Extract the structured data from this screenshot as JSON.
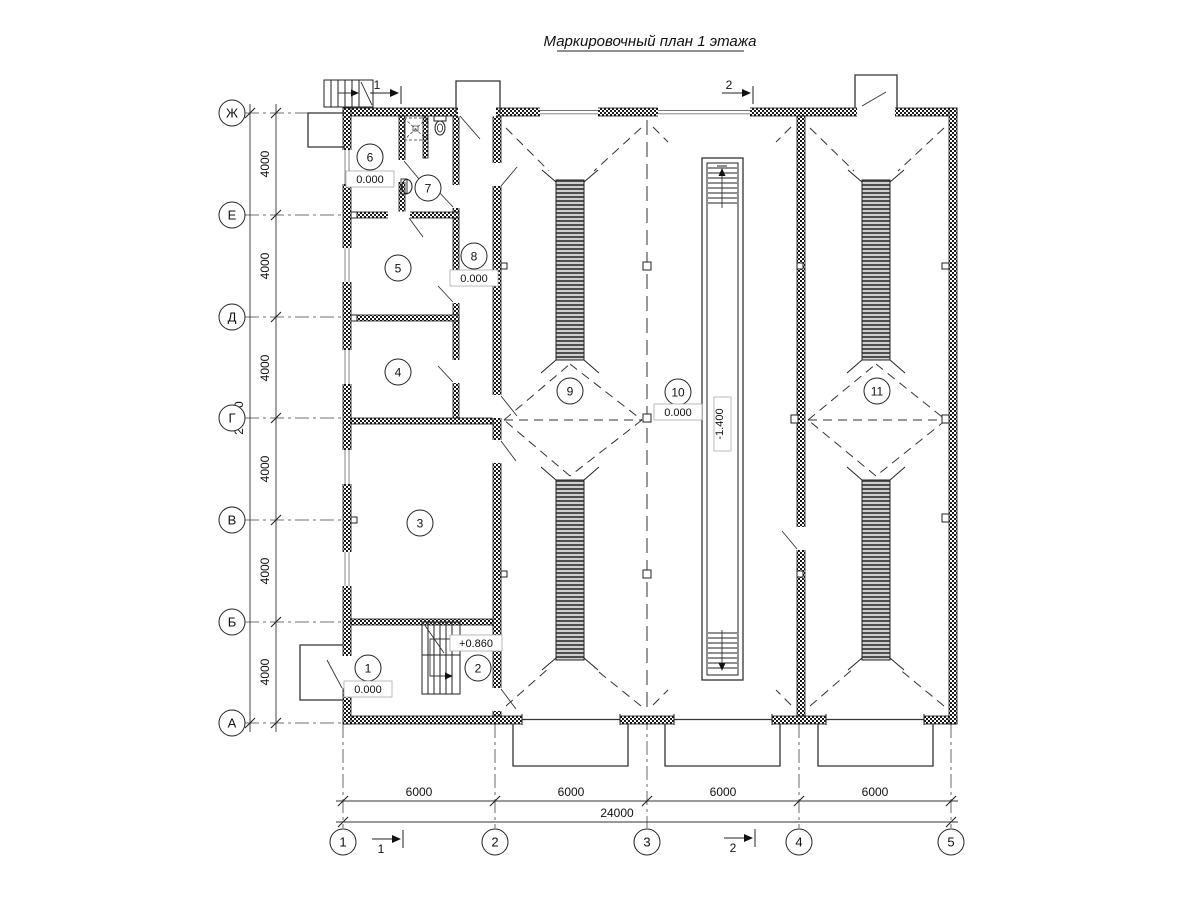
{
  "title": "Маркировочный план 1 этажа",
  "axes": {
    "rows": [
      "Ж",
      "Е",
      "Д",
      "Г",
      "В",
      "Б",
      "А"
    ],
    "cols": [
      "1",
      "2",
      "3",
      "4",
      "5"
    ]
  },
  "dimensions": {
    "left_segments": [
      "4000",
      "4000",
      "4000",
      "4000",
      "4000",
      "4000"
    ],
    "left_total": "24000",
    "bottom_segments": [
      "6000",
      "6000",
      "6000",
      "6000"
    ],
    "bottom_total": "24000"
  },
  "rooms": [
    {
      "num": "1",
      "elev": "0.000"
    },
    {
      "num": "2",
      "elev": "+0.860"
    },
    {
      "num": "3"
    },
    {
      "num": "4"
    },
    {
      "num": "5"
    },
    {
      "num": "6",
      "elev": "0.000"
    },
    {
      "num": "7"
    },
    {
      "num": "8",
      "elev": "0.000"
    },
    {
      "num": "9"
    },
    {
      "num": "10",
      "elev": "0.000"
    },
    {
      "num": "11"
    }
  ],
  "pit": {
    "elev": "-1.400"
  },
  "sections": {
    "one": "1",
    "two": "2"
  }
}
